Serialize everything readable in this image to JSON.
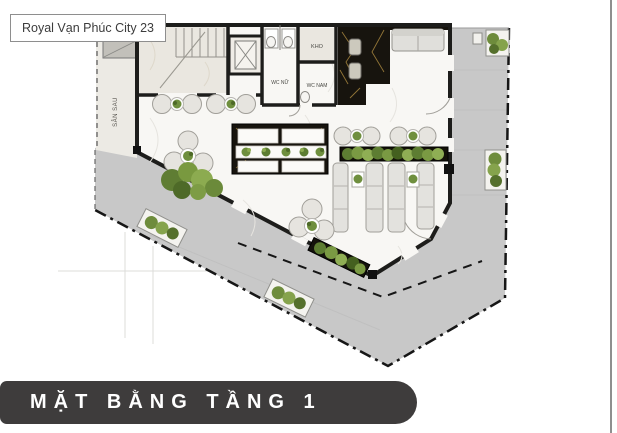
{
  "image_title": {
    "label": "Royal Vạn Phúc City 23"
  },
  "banner": {
    "label": "MẶT BẰNG TẦNG 1"
  },
  "floorplan": {
    "labels": {
      "back_yard": "SÂN SAU",
      "wc_female": "WC NỮ",
      "wc_male": "WC NAM",
      "storage": "KHO"
    },
    "colors": {
      "paving_gray": "#c8c8c8",
      "marble_white": "#f8f7f4",
      "marble_beige": "#eae7e0",
      "marble_black": "#17140e",
      "gold_vein": "#a8873f",
      "plant_green": "#6f8f3e",
      "plant_green_dark": "#4e6a28",
      "plant_green_light": "#8cab50",
      "wall_black": "#1d1d1b",
      "banner_bg": "#3e3c3c",
      "furniture_fill": "#e3e2de",
      "furniture_stroke": "#a19f99"
    }
  }
}
